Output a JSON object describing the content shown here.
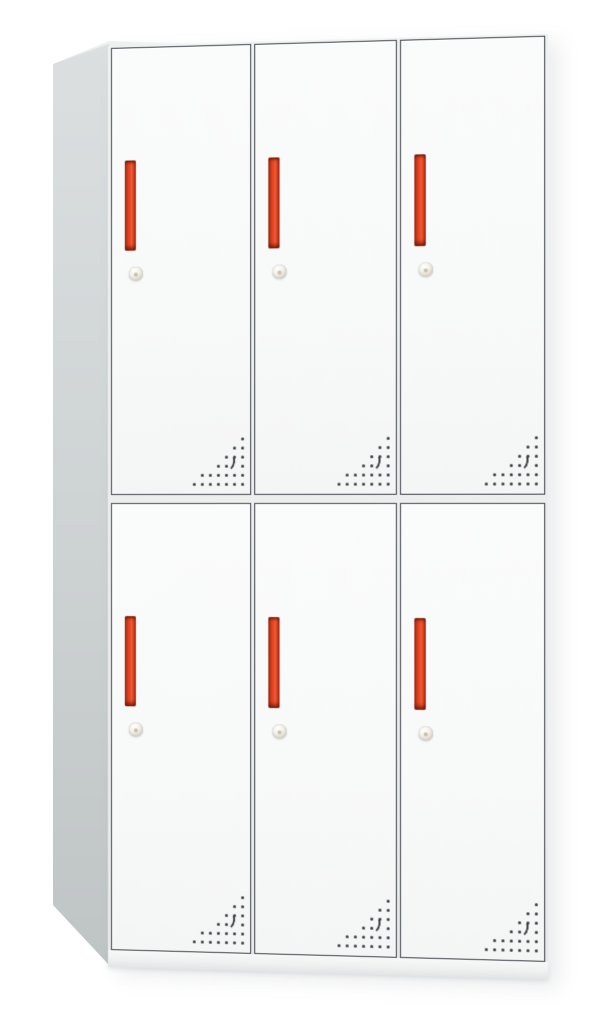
{
  "photo": {
    "subject": "six-door-steel-locker-cabinet",
    "background_color": "#ffffff"
  },
  "cabinet": {
    "rows": 2,
    "columns": 3,
    "door_count": 6,
    "colors": {
      "door_face": "#f8f9f9",
      "frame_line": "#41464b",
      "frame_gap": "#e9ebeb",
      "side_panel_light": "#dbdfe0",
      "side_panel_dark": "#bfc4c5",
      "handle_red": "#e84b28",
      "handle_red_dark": "#9c2a12",
      "handle_red_highlight": "#f25c33",
      "keyhole_silver": "#ddd9cd",
      "vent_dot": "#3a3f43",
      "base_plinth": "#eff1f1"
    },
    "handle_style": "vertical-red-bar-handle",
    "lock_style": "round-cam-lock-keyhole",
    "vent_pattern": {
      "shape": "right-triangle-dot-grid",
      "rows_dot_counts": [
        1,
        2,
        3,
        4,
        6,
        7
      ],
      "has_crescent_mark": true
    },
    "doors": [
      {
        "id": "door-r1c1",
        "row": 1,
        "col": 1
      },
      {
        "id": "door-r1c2",
        "row": 1,
        "col": 2
      },
      {
        "id": "door-r1c3",
        "row": 1,
        "col": 3
      },
      {
        "id": "door-r2c1",
        "row": 2,
        "col": 1
      },
      {
        "id": "door-r2c2",
        "row": 2,
        "col": 2
      },
      {
        "id": "door-r2c3",
        "row": 2,
        "col": 3
      }
    ]
  }
}
